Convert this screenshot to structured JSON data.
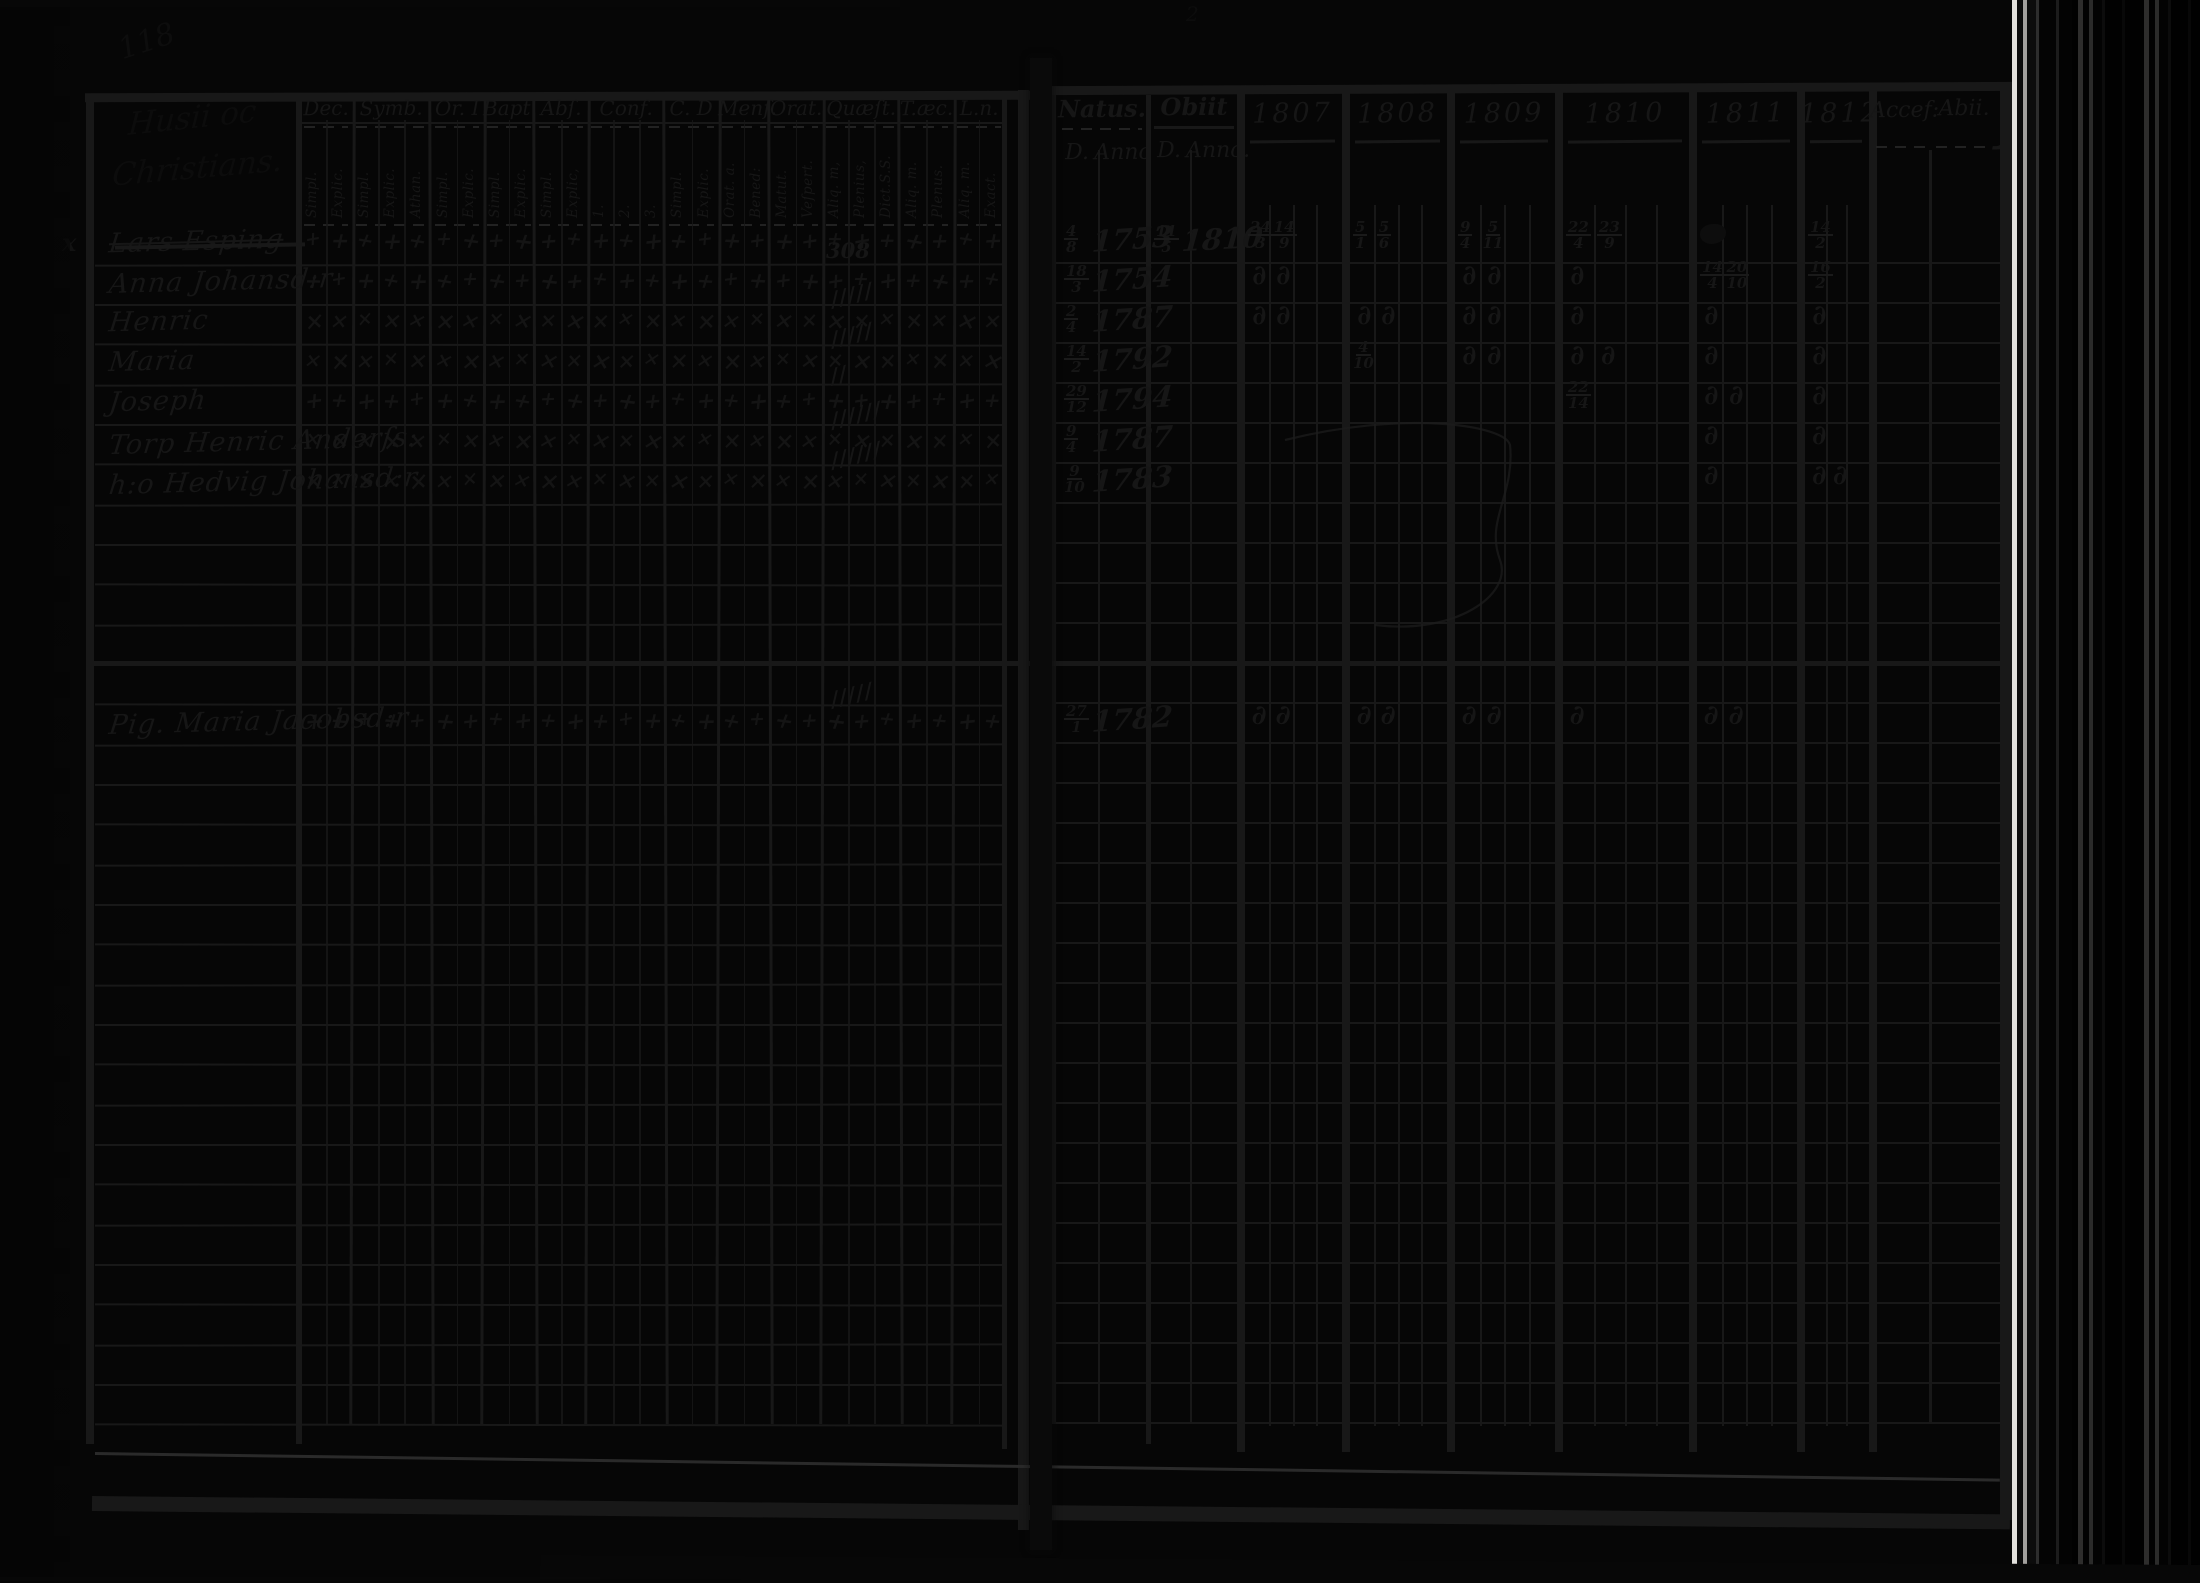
{
  "meta": {
    "page_number": "118",
    "header_note_line1": "Husii oc",
    "header_note_line2": "Christians.",
    "stray_mark_top_right": "2",
    "margin_mark_row1": "x"
  },
  "left_table": {
    "groups": [
      {
        "label": "Dec.",
        "subs": [
          "Simpl.",
          "Explic."
        ]
      },
      {
        "label": "Symb.",
        "subs": [
          "Simpl.",
          "Explic.",
          "Athan."
        ]
      },
      {
        "label": "Or. I",
        "subs": [
          "Simpl.",
          "Explic."
        ]
      },
      {
        "label": "Bapt.",
        "subs": [
          "Simpl.",
          "Explic."
        ]
      },
      {
        "label": "Abſ.",
        "subs": [
          "Simpl.",
          "Explic,"
        ]
      },
      {
        "label": "Conf.",
        "subs": [
          "1.",
          "2.",
          "3."
        ]
      },
      {
        "label": "C. D",
        "subs": [
          "Simpl.",
          "Explic."
        ]
      },
      {
        "label": "Menſ.",
        "subs": [
          "Orat. a.",
          "Bened:"
        ]
      },
      {
        "label": "Orat.",
        "subs": [
          "Matut.",
          "Veſpert."
        ]
      },
      {
        "label": "Quæſt.",
        "subs": [
          "Aliq. m,",
          "Plenius,",
          "Dict.S.S."
        ]
      },
      {
        "label": "T.æc.",
        "subs": [
          "Aliq. m.",
          "Plenus."
        ]
      },
      {
        "label": "L.n.",
        "subs": [
          "Aliq. m.",
          "Exact."
        ]
      }
    ]
  },
  "right_table": {
    "natus_label": "Natus.",
    "natus_d": "D.",
    "natus_anno": "Anno",
    "obiit_label": "Obiit",
    "obiit_d": "D.",
    "obiit_anno": "Anno.",
    "years": [
      "1807",
      "1808",
      "1809",
      "1810",
      "1811",
      "1812"
    ],
    "acces_label": "Accef:",
    "abii_label": "Abii."
  },
  "rows": [
    {
      "i": 0,
      "name": "Lars Esping",
      "struck": true,
      "mark": "plus",
      "natus_d": "4|8",
      "natus_anno": "1753",
      "obiit_d": "11|5",
      "obiit_anno": "1810",
      "years": {
        "1807": [
          "24|3",
          "14|9"
        ],
        "1808": [
          "5|1",
          "5|6"
        ],
        "1809": [
          "9|4",
          "5|11"
        ],
        "1810": [
          "22|4",
          "23|9"
        ],
        "1811": [
          "blot"
        ],
        "1812": [
          "14|2"
        ]
      }
    },
    {
      "i": 1,
      "name": "Anna Johansd:r",
      "mark": "plus",
      "note": "308",
      "natus_d": "18|3",
      "natus_anno": "1754",
      "years": {
        "1807": [
          "d",
          "d"
        ],
        "1809": [
          "d",
          "d"
        ],
        "1810": [
          "d"
        ],
        "1811": [
          "14|4",
          "20|10"
        ],
        "1812": [
          "16|2"
        ]
      }
    },
    {
      "i": 2,
      "name": "Henric",
      "mark": "cross",
      "tally": "/////",
      "natus_d": "2|4",
      "natus_anno": "1787",
      "years": {
        "1807": [
          "d",
          "d"
        ],
        "1808": [
          "d",
          "d"
        ],
        "1809": [
          "d",
          "d"
        ],
        "1810": [
          "d"
        ],
        "1811": [
          "d"
        ],
        "1812": [
          "d"
        ]
      }
    },
    {
      "i": 3,
      "name": "Maria",
      "mark": "cross",
      "tally": "/////",
      "natus_d": "14|2",
      "natus_anno": "1792",
      "years": {
        "1808": [
          "4|10"
        ],
        "1809": [
          "d",
          "d"
        ],
        "1810": [
          "d",
          "d"
        ],
        "1811": [
          "d"
        ],
        "1812": [
          "d"
        ]
      }
    },
    {
      "i": 4,
      "name": "Joseph",
      "mark": "plus",
      "tally": "//",
      "natus_d": "29|12",
      "natus_anno": "1794",
      "years": {
        "1810": [
          "22|14"
        ],
        "1811": [
          "d",
          "d"
        ],
        "1812": [
          "d"
        ]
      }
    },
    {
      "i": 5,
      "name": "Torp Henric Anderſs:",
      "mark": "cross",
      "tally": "//////",
      "natus_d": "9|4",
      "natus_anno": "1787",
      "years": {
        "1811": [
          "d"
        ],
        "1812": [
          "d"
        ]
      }
    },
    {
      "i": 6,
      "name": "h:o Hedvig Johansd:r",
      "mark": "cross",
      "tally": "//////",
      "natus_d": "9|10",
      "natus_anno": "1783",
      "years": {
        "1811": [
          "d"
        ],
        "1812": [
          "d",
          "d"
        ]
      }
    },
    {
      "i": 12,
      "name": "Pig. Maria Jacobsd:r",
      "mark": "plus",
      "tally": "/////",
      "section_rule": true,
      "natus_d": "27|1",
      "natus_anno": "1782",
      "years": {
        "1807": [
          "d",
          "d"
        ],
        "1808": [
          "d",
          "d"
        ],
        "1809": [
          "d",
          "d"
        ],
        "1810": [
          "d"
        ],
        "1811": [
          "d",
          "d"
        ]
      }
    }
  ],
  "glyphs": {
    "plus": "+",
    "cross": "×",
    "commune": "∂"
  }
}
